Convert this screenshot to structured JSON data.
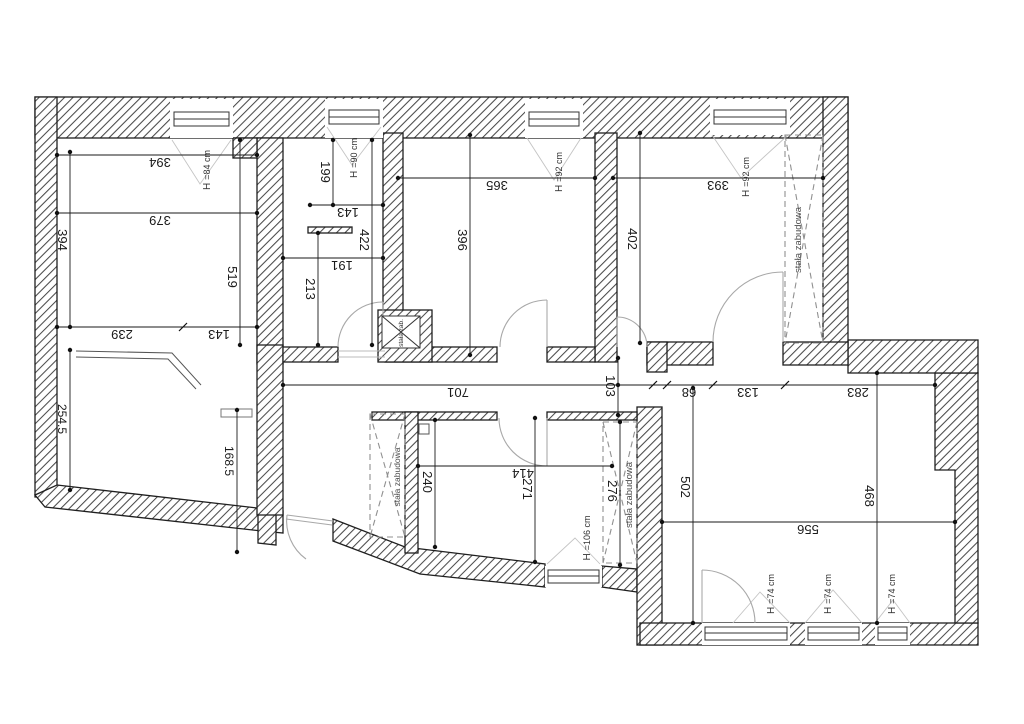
{
  "plan": {
    "dimensions": {
      "room1": {
        "top": "394",
        "inner": "379",
        "left": "394",
        "right": "519",
        "bottom_left": "239",
        "bottom_right": "143"
      },
      "hall": {
        "height_upper": "199",
        "width_upper": "143",
        "height_full": "422",
        "width_lower": "191",
        "height_lower": "213"
      },
      "room2": {
        "width": "365",
        "height": "396"
      },
      "room3": {
        "width": "393",
        "height": "402"
      },
      "corridor": {
        "length": "701",
        "width": "103",
        "seg1": "68",
        "seg2": "133",
        "seg3": "283"
      },
      "room4": {
        "left": "254.5",
        "right": "168.5"
      },
      "room5": {
        "left": "240",
        "width": "414",
        "middle": "271",
        "right": "276"
      },
      "room6": {
        "left": "502",
        "width": "556",
        "right": "468"
      }
    },
    "window_labels": {
      "w1": {
        "prefix": "H",
        "value": "=84 cm"
      },
      "w2": {
        "prefix": "H",
        "value": "=90 cm"
      },
      "w3": {
        "prefix": "H",
        "value": "=92 cm"
      },
      "w4": {
        "prefix": "H",
        "value": "=92 cm"
      },
      "w5": {
        "prefix": "H",
        "value": "=106 cm"
      },
      "w6": {
        "prefix": "H",
        "value": "=74 cm"
      },
      "w7": {
        "prefix": "H",
        "value": "=74 cm"
      },
      "w8": {
        "prefix": "H",
        "value": "=74 cm"
      }
    },
    "annotations": {
      "wardrobe_room3": "stała zabudowa",
      "wardrobe_left": "stała zabudowa",
      "wardrobe_right": "stała zabudowa",
      "closet": "stała zab."
    },
    "colors": {
      "wall_line": "#1f1f1f",
      "hatch": "#4a4a4a",
      "dim_line": "#1a1a1a",
      "door": "#a8a8a8",
      "dashed": "#909090",
      "background": "#ffffff"
    }
  }
}
